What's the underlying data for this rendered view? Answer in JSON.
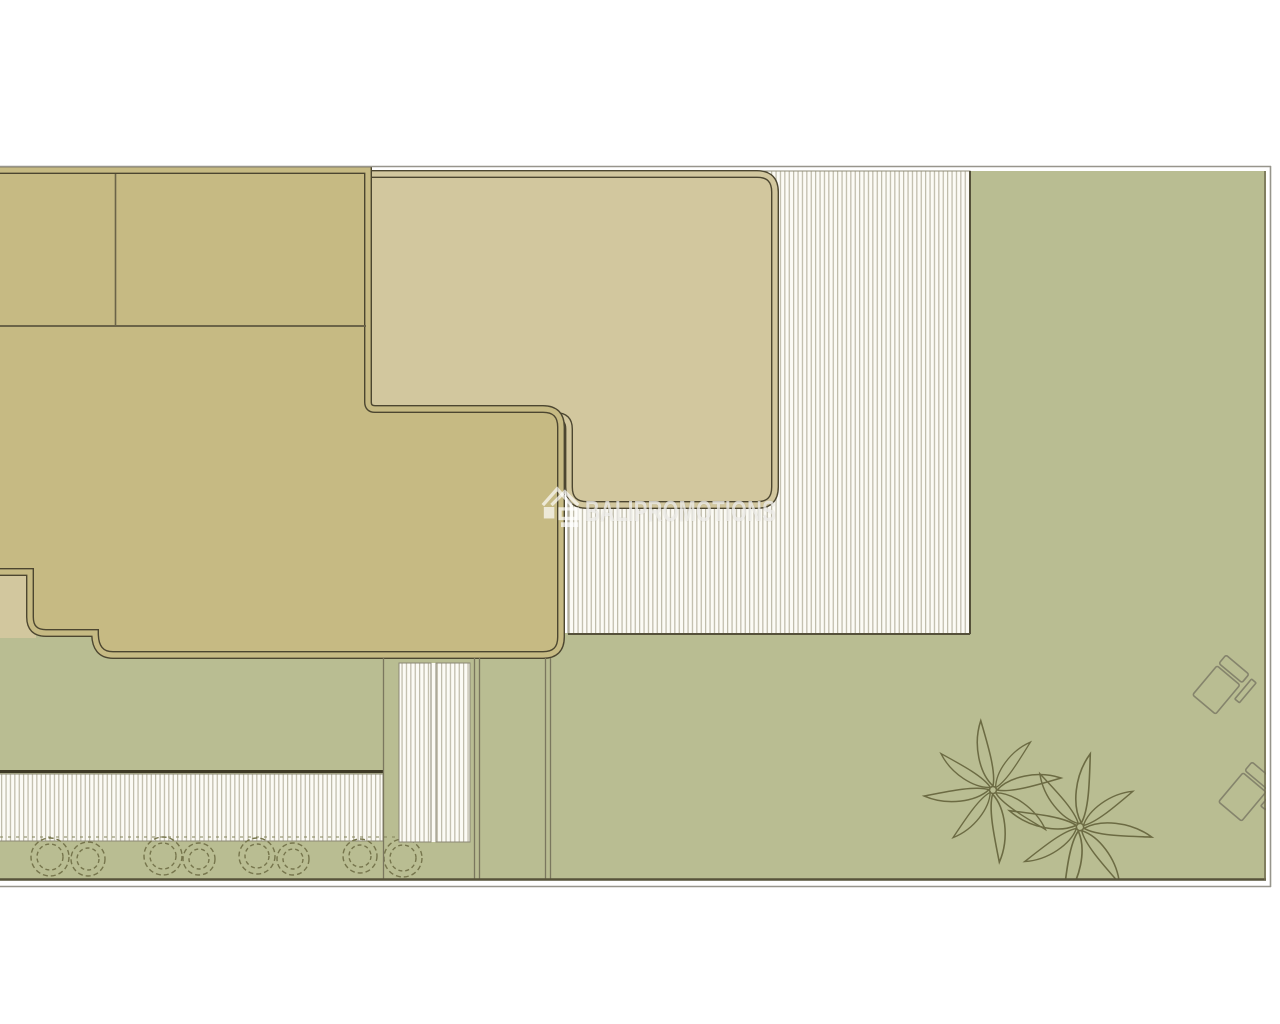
{
  "watermark": {
    "text": "BALIPROMOTIONS",
    "logo": "house-roofs-logo",
    "opacity": "0.68"
  },
  "palette": {
    "building": "#c6ba83",
    "terrace": "#d2c79e",
    "lawn": "#b9bd92",
    "hatch_bg": "#fcfbf5",
    "hatch_line": "#b7b3a0",
    "outline_dark": "#4c4630",
    "thin_border": "#8a8774",
    "plan_border_grey": "#97958c",
    "garden_wall_dark": "#3e3a26",
    "planting_stroke": "#76754c"
  },
  "decor": {
    "palm_trees": 2,
    "sun_loungers": 2,
    "shrubs": 8
  }
}
